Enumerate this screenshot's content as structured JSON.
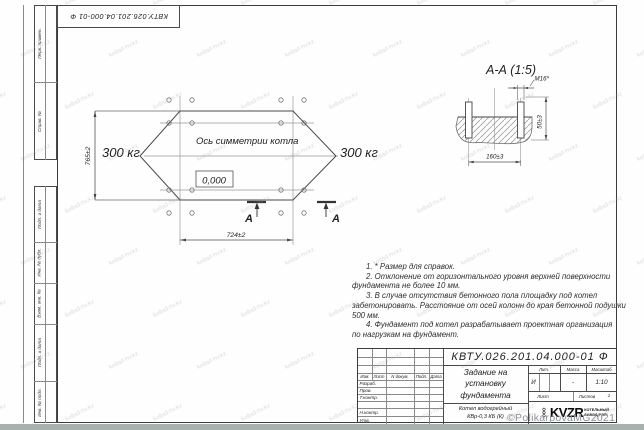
{
  "colors": {
    "line": "#3f3f3f",
    "bottom_strip": "#a7b2ae",
    "watermark": "#9aa6ad",
    "copyright_gray": "#8b9298"
  },
  "stamp": {
    "designation": "КВТУ.026.201.04.000-01 Ф"
  },
  "margin": {
    "labels": [
      "Перв. примен.",
      "Справ. №",
      "Подп. и дата",
      "Инв. № дубл.",
      "Взам. инв. №",
      "Подп. и дата",
      "Инв. № подл."
    ]
  },
  "plan": {
    "axis_label": "Ось симметрии котла",
    "level_mark": "0,000",
    "load_left": "300 кг",
    "load_right": "300 кг",
    "dim_height": "765±2",
    "dim_width": "724±2",
    "section_letter_left": "А",
    "section_letter_right": "А"
  },
  "section": {
    "title": "А-А (1:5)",
    "dim_thread": "М16*",
    "dim_spacing": "160±3",
    "dim_depth": "50±3"
  },
  "notes": {
    "lines": [
      "1. * Размер для справок.",
      "2. Отклонение от горизонтального уровня верхней поверхности",
      "фундамента не более 10 мм.",
      "3. В случае отсутствия бетонного пола площадку под котел",
      "забетонировать. Расстояние от осей колонн до края бетонной подушки",
      "500 мм.",
      "4. Фундамент под котел разрабатывает проектная организация",
      "по нагрузкам на фундамент."
    ]
  },
  "title_block": {
    "designation": "КВТУ.026.201.04.000-01 Ф",
    "doc_title_line1": "Задание на",
    "doc_title_line2": "установку",
    "doc_title_line3": "фундамента",
    "product_line1": "Котел водогрейный",
    "product_line2": "КВр-0,3 КБ (К)",
    "col_izm": "Изм.",
    "col_list": "Лист",
    "col_ndocum": "N докум.",
    "col_podp": "Подп.",
    "col_data": "Дата",
    "row_razrab": "Разраб.",
    "row_prov": "Пров.",
    "row_tkontr": "Т.контр.",
    "row_nkontr": "Н.контр.",
    "row_utv": "Утв.",
    "lit_label": "Лит.",
    "massa_label": "Масса",
    "masshtab_label": "Масштаб",
    "lit_value": "И",
    "massa_value": "-",
    "masshtab_value": "1:10",
    "list_label": "Лист",
    "listov_label": "Листов",
    "listov_value": "1",
    "logo_org": "ООО",
    "logo_name": "KVZR",
    "logo_sub1": "КОТЕЛЬНЫЙ",
    "logo_sub2": "ЗАВОД РЭП"
  },
  "watermark": {
    "tile_text": "kotlad-hv.kz",
    "copyright": "©PolikarpovaMG2021"
  }
}
